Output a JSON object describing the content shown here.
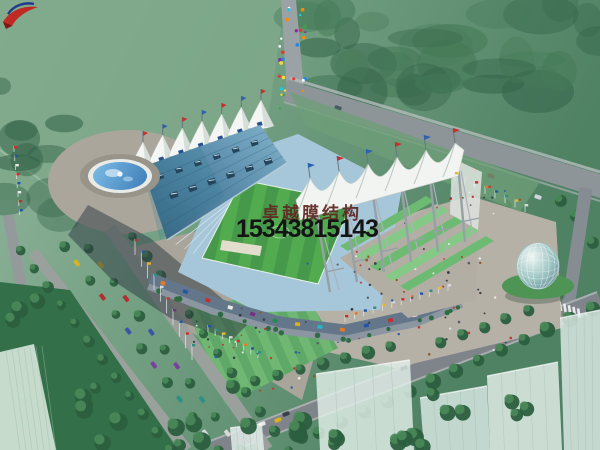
{
  "scene": {
    "description": "Aerial architectural rendering: stadium with white tensile-membrane roof peaks, blue grandstand roof, striped football pitch, green terraced steps, fountain plaza, tree-lined boulevard with parked cars, glass egg-shaped pavilion, roads and ghosted white high-rise massing in the foreground"
  },
  "watermark": {
    "logo_icon": "red-swoosh-logo",
    "company_name": "卓越膜结构",
    "phone_number": "15343815143",
    "company_color": "#5e2a24",
    "phone_color": "#141414"
  },
  "palette": {
    "haze_green": "#7fa98b",
    "forest_green": "#3f7553",
    "lawn_green": "#5fa868",
    "pitch_green": "#53ab4f",
    "terrace_green": "#6dbb72",
    "roof_blue": "#4f85a3",
    "membrane_white": "#f2f5f2",
    "seat_blue": "#a6c6da",
    "plaza_gray": "#b6b1a7",
    "road_gray": "#8d9599",
    "shadow_slate": "#2c3840",
    "fountain_blue": "#4f96cc",
    "dome_glass": "#9cc4c2",
    "logo_red": "#bf2b24"
  }
}
